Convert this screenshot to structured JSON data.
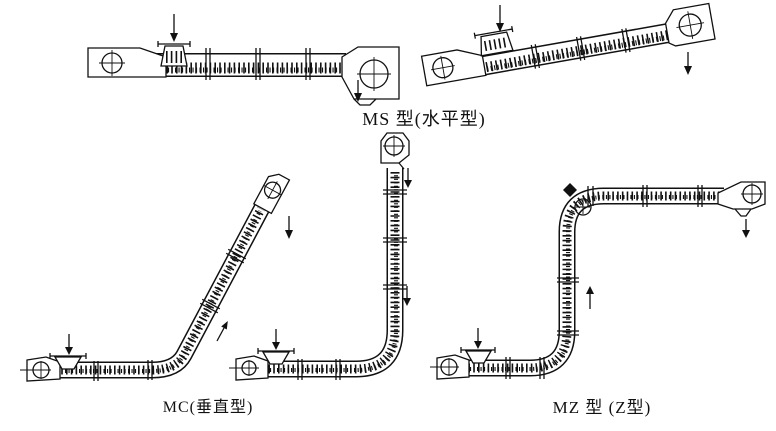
{
  "page": {
    "background": "#ffffff",
    "ink": "#111111"
  },
  "captions": {
    "ms": "MS 型(水平型)",
    "mc": "MC(垂直型)",
    "mz": "MZ 型 (Z型)"
  }
}
